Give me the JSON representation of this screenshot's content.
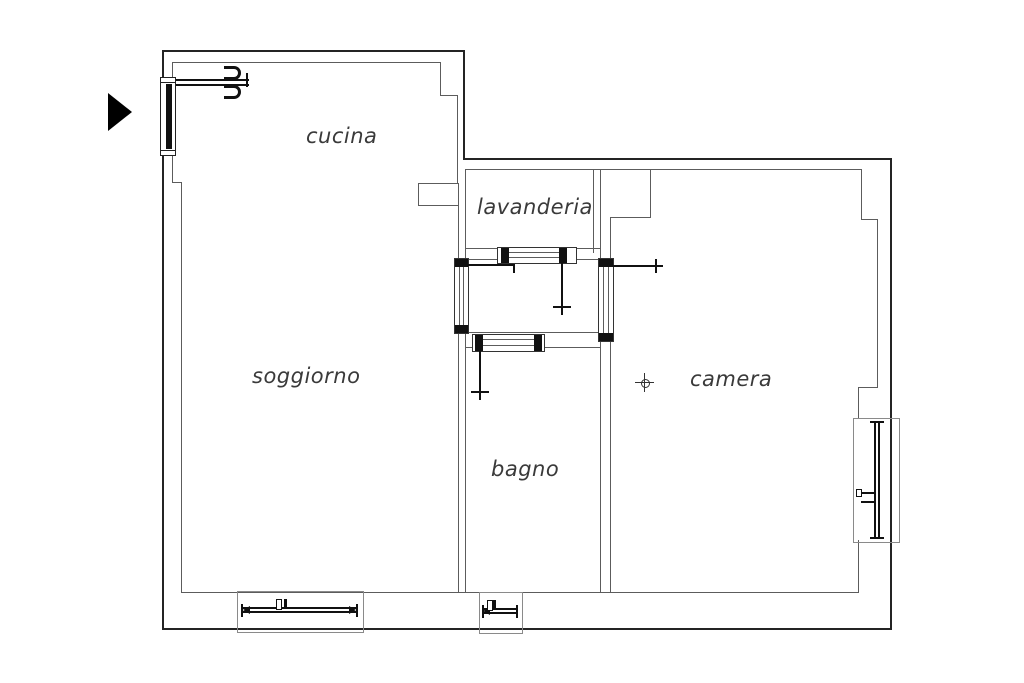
{
  "drawing": {
    "type": "apartment-floor-plan",
    "background_color": "#ffffff",
    "outer_wall_color": "#242424",
    "inner_wall_color": "#5c5c5c",
    "symbol_color": "#111111",
    "label_color": "#3a3a3a"
  },
  "rooms": [
    {
      "name": "cucina",
      "label": "cucina"
    },
    {
      "name": "lavanderia",
      "label": "lavanderia"
    },
    {
      "name": "soggiorno",
      "label": "soggiorno"
    },
    {
      "name": "bagno",
      "label": "bagno"
    },
    {
      "name": "camera",
      "label": "camera"
    }
  ],
  "symbols": {
    "north_arrow": "black right-pointing triangle",
    "entrance_door": "open leaf with hinge hooks at top-left wall",
    "doors": [
      "soggiorno-hall-door",
      "lavanderia-hall-door",
      "camera-hall-door",
      "bagno-hall-door"
    ],
    "windows": [
      "left-wall-window",
      "soggiorno-bottom-window",
      "bagno-bottom-window",
      "camera-right-window"
    ],
    "center_mark": "crosshair circle in camera"
  }
}
